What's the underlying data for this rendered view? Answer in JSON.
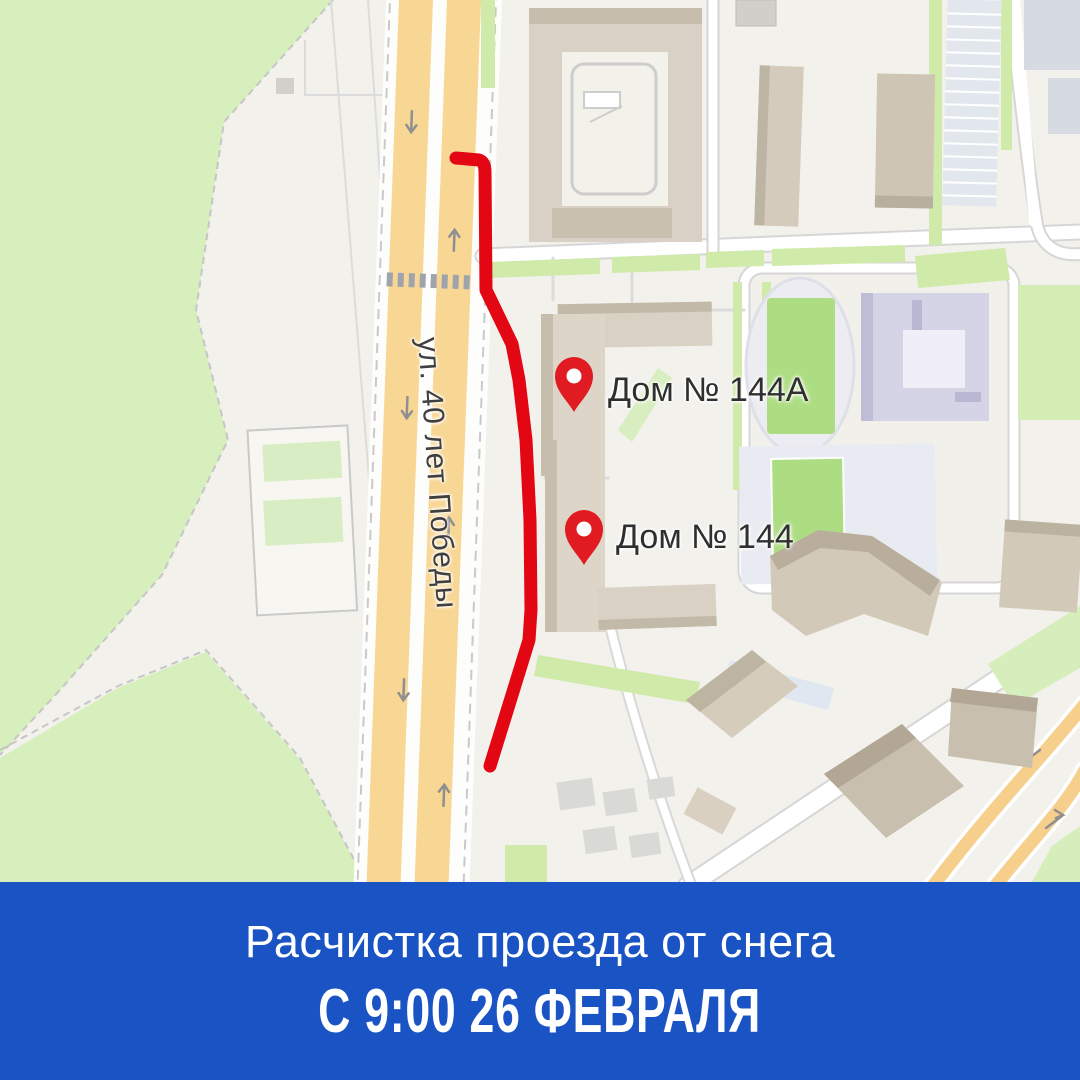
{
  "map": {
    "street_label": "ул. 40 лет Победы",
    "pins": [
      {
        "label": "Дом № 144А"
      },
      {
        "label": "Дом № 144"
      }
    ]
  },
  "banner": {
    "line1": "Расчистка проезда от снега",
    "line2": "С 9:00 26 ФЕВРАЛЯ"
  },
  "colors": {
    "banner_blue": "#1a53c4",
    "route_red": "#e30613",
    "pin_red": "#e11b22",
    "road_yellow": "#f8d795",
    "park_green": "#d6efbc",
    "map_background": "#f2f1ec"
  }
}
